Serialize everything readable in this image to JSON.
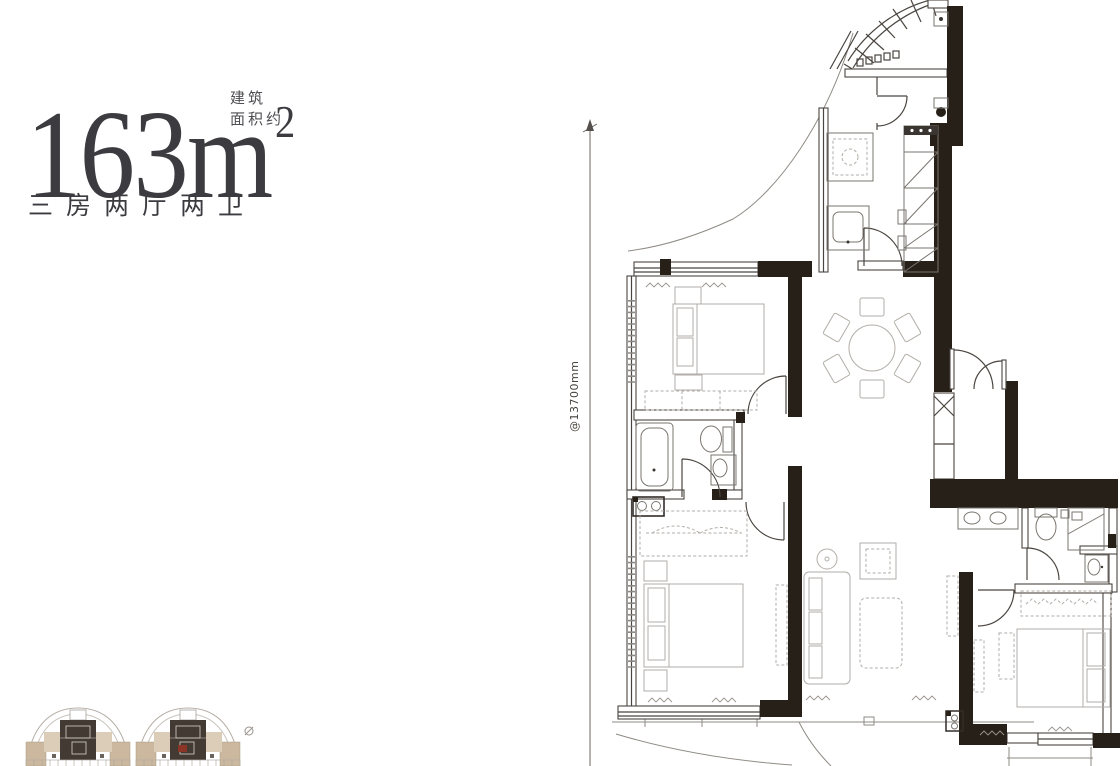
{
  "header": {
    "area_value": "163",
    "area_unit": "m",
    "area_sup": "2",
    "build_label": "建筑",
    "approx_label": "面积约",
    "layout_label": "三房两厅两卫"
  },
  "dimension": {
    "label": "@13700mm"
  },
  "floor_plan": {
    "type": "residential-floor-plan",
    "rooms_depicted": [
      "kitchen",
      "laundry",
      "bedroom",
      "bathroom",
      "dining-area",
      "master-bedroom",
      "living-room",
      "second-bathroom",
      "third-bedroom",
      "entry",
      "balcony"
    ],
    "icon_names": [
      "dining-table-icon",
      "sofa-icon",
      "bed-icon",
      "bathtub-icon",
      "toilet-icon",
      "sink-icon",
      "wardrobe-icon",
      "stove-icon",
      "washer-icon",
      "door-arc-icon",
      "dimension-arrow-icon"
    ]
  },
  "colors": {
    "wall_black": "#262019",
    "line_dark": "#4a4540",
    "line_light": "#8f8b85",
    "furniture_line": "#b2aea8",
    "title_color": "#3b3b40",
    "keyplan_tan": "#cbb89f",
    "keyplan_core": "#423a33",
    "marker_red": "#8a3526"
  }
}
